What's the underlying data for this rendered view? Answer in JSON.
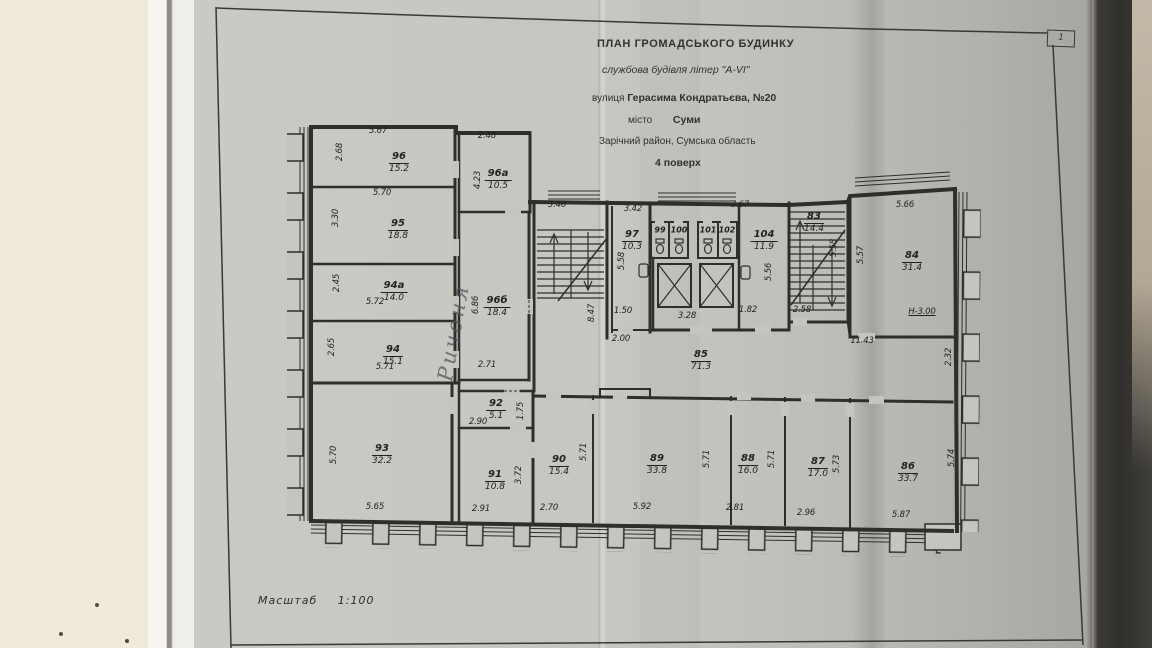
{
  "photo": {
    "corner_page_number": "1"
  },
  "title_block": {
    "line1": "ПЛАН  ГРОМАДСЬКОГО  БУДИНКУ",
    "line2": "службова будівля літер \"А-VI\"",
    "line3_label": "вулиця",
    "line3_value": "Герасима Кондратьєва, №20",
    "line4_label": "місто",
    "line4_value": "Суми",
    "line5": "Зарічний район, Сумська область",
    "line6": "4 поверх"
  },
  "scale": {
    "label": "Масштаб",
    "value": "1:100"
  },
  "handwritten_note": "Ричоня",
  "plan": {
    "rooms": [
      {
        "num": "96",
        "area": "15.2",
        "x": 399,
        "y": 146
      },
      {
        "num": "95",
        "area": "18.8",
        "x": 398,
        "y": 213
      },
      {
        "num": "94а",
        "area": "14.0",
        "x": 394,
        "y": 275
      },
      {
        "num": "94",
        "area": "15.1",
        "x": 393,
        "y": 339
      },
      {
        "num": "93",
        "area": "32.2",
        "x": 382,
        "y": 438
      },
      {
        "num": "96а",
        "area": "10.5",
        "x": 498,
        "y": 163
      },
      {
        "num": "96б",
        "area": "18.4",
        "x": 497,
        "y": 290
      },
      {
        "num": "92",
        "area": "5.1",
        "x": 496,
        "y": 393
      },
      {
        "num": "91",
        "area": "10.8",
        "x": 495,
        "y": 464
      },
      {
        "num": "97",
        "area": "10.3",
        "x": 632,
        "y": 224
      },
      {
        "num": "104",
        "area": "11.9",
        "x": 764,
        "y": 224
      },
      {
        "num": "85",
        "area": "71.3",
        "x": 701,
        "y": 344
      },
      {
        "num": "83",
        "area": "14.4",
        "x": 814,
        "y": 206
      },
      {
        "num": "84",
        "area": "31.4",
        "x": 912,
        "y": 245
      },
      {
        "num": "90",
        "area": "15.4",
        "x": 559,
        "y": 449
      },
      {
        "num": "89",
        "area": "33.8",
        "x": 657,
        "y": 448
      },
      {
        "num": "88",
        "area": "16.0",
        "x": 748,
        "y": 448
      },
      {
        "num": "87",
        "area": "17.0",
        "x": 818,
        "y": 451
      },
      {
        "num": "86",
        "area": "33.7",
        "x": 908,
        "y": 456
      }
    ],
    "wc_stalls": [
      {
        "num": "99",
        "x": 660,
        "y": 230
      },
      {
        "num": "100",
        "x": 679,
        "y": 230
      },
      {
        "num": "101",
        "x": 708,
        "y": 230
      },
      {
        "num": "102",
        "x": 727,
        "y": 230
      }
    ],
    "dims": [
      {
        "t": "5.67",
        "x": 378,
        "y": 131
      },
      {
        "t": "2.68",
        "x": 340,
        "y": 152,
        "r": -90
      },
      {
        "t": "5.70",
        "x": 382,
        "y": 193
      },
      {
        "t": "3.30",
        "x": 336,
        "y": 218,
        "r": -90
      },
      {
        "t": "2.45",
        "x": 337,
        "y": 283,
        "r": -90
      },
      {
        "t": "5.72",
        "x": 375,
        "y": 302
      },
      {
        "t": "2.65",
        "x": 332,
        "y": 347,
        "r": -90
      },
      {
        "t": "5.71",
        "x": 385,
        "y": 367
      },
      {
        "t": "5.70",
        "x": 334,
        "y": 455,
        "r": -90
      },
      {
        "t": "5.65",
        "x": 375,
        "y": 507
      },
      {
        "t": "2.48",
        "x": 487,
        "y": 136
      },
      {
        "t": "4.23",
        "x": 478,
        "y": 180,
        "r": -90
      },
      {
        "t": "6.86",
        "x": 476,
        "y": 305,
        "r": -90
      },
      {
        "t": "2.71",
        "x": 487,
        "y": 365
      },
      {
        "t": "1.75",
        "x": 521,
        "y": 411,
        "r": -90
      },
      {
        "t": "2.90",
        "x": 478,
        "y": 422
      },
      {
        "t": "3.72",
        "x": 519,
        "y": 475,
        "r": -90
      },
      {
        "t": "2.91",
        "x": 481,
        "y": 509
      },
      {
        "t": "3.40",
        "x": 557,
        "y": 205
      },
      {
        "t": "8.47",
        "x": 592,
        "y": 313,
        "r": -90
      },
      {
        "t": "3.42",
        "x": 633,
        "y": 209
      },
      {
        "t": "5.58",
        "x": 622,
        "y": 261,
        "r": -90
      },
      {
        "t": "1.50",
        "x": 623,
        "y": 311
      },
      {
        "t": "2.00",
        "x": 621,
        "y": 339
      },
      {
        "t": "3.67",
        "x": 740,
        "y": 205
      },
      {
        "t": "5.56",
        "x": 769,
        "y": 272,
        "r": -90
      },
      {
        "t": "3.28",
        "x": 687,
        "y": 316
      },
      {
        "t": "1.82",
        "x": 748,
        "y": 310
      },
      {
        "t": "5.58",
        "x": 834,
        "y": 248,
        "r": -90
      },
      {
        "t": "2.58",
        "x": 802,
        "y": 310
      },
      {
        "t": "5.57",
        "x": 861,
        "y": 255,
        "r": -90
      },
      {
        "t": "5.66",
        "x": 905,
        "y": 205
      },
      {
        "t": "Н-3.00",
        "x": 922,
        "y": 312,
        "u": true
      },
      {
        "t": "11.43",
        "x": 862,
        "y": 341
      },
      {
        "t": "2.32",
        "x": 949,
        "y": 357,
        "r": -90
      },
      {
        "t": "5.71",
        "x": 584,
        "y": 452,
        "r": -90
      },
      {
        "t": "2.70",
        "x": 549,
        "y": 508
      },
      {
        "t": "5.92",
        "x": 642,
        "y": 507
      },
      {
        "t": "5.71",
        "x": 707,
        "y": 459,
        "r": -90
      },
      {
        "t": "2.81",
        "x": 735,
        "y": 508
      },
      {
        "t": "5.71",
        "x": 772,
        "y": 459,
        "r": -90
      },
      {
        "t": "2.96",
        "x": 806,
        "y": 513
      },
      {
        "t": "5.73",
        "x": 837,
        "y": 464,
        "r": -90
      },
      {
        "t": "5.87",
        "x": 901,
        "y": 515
      },
      {
        "t": "5.74",
        "x": 952,
        "y": 458,
        "r": -90
      }
    ]
  }
}
